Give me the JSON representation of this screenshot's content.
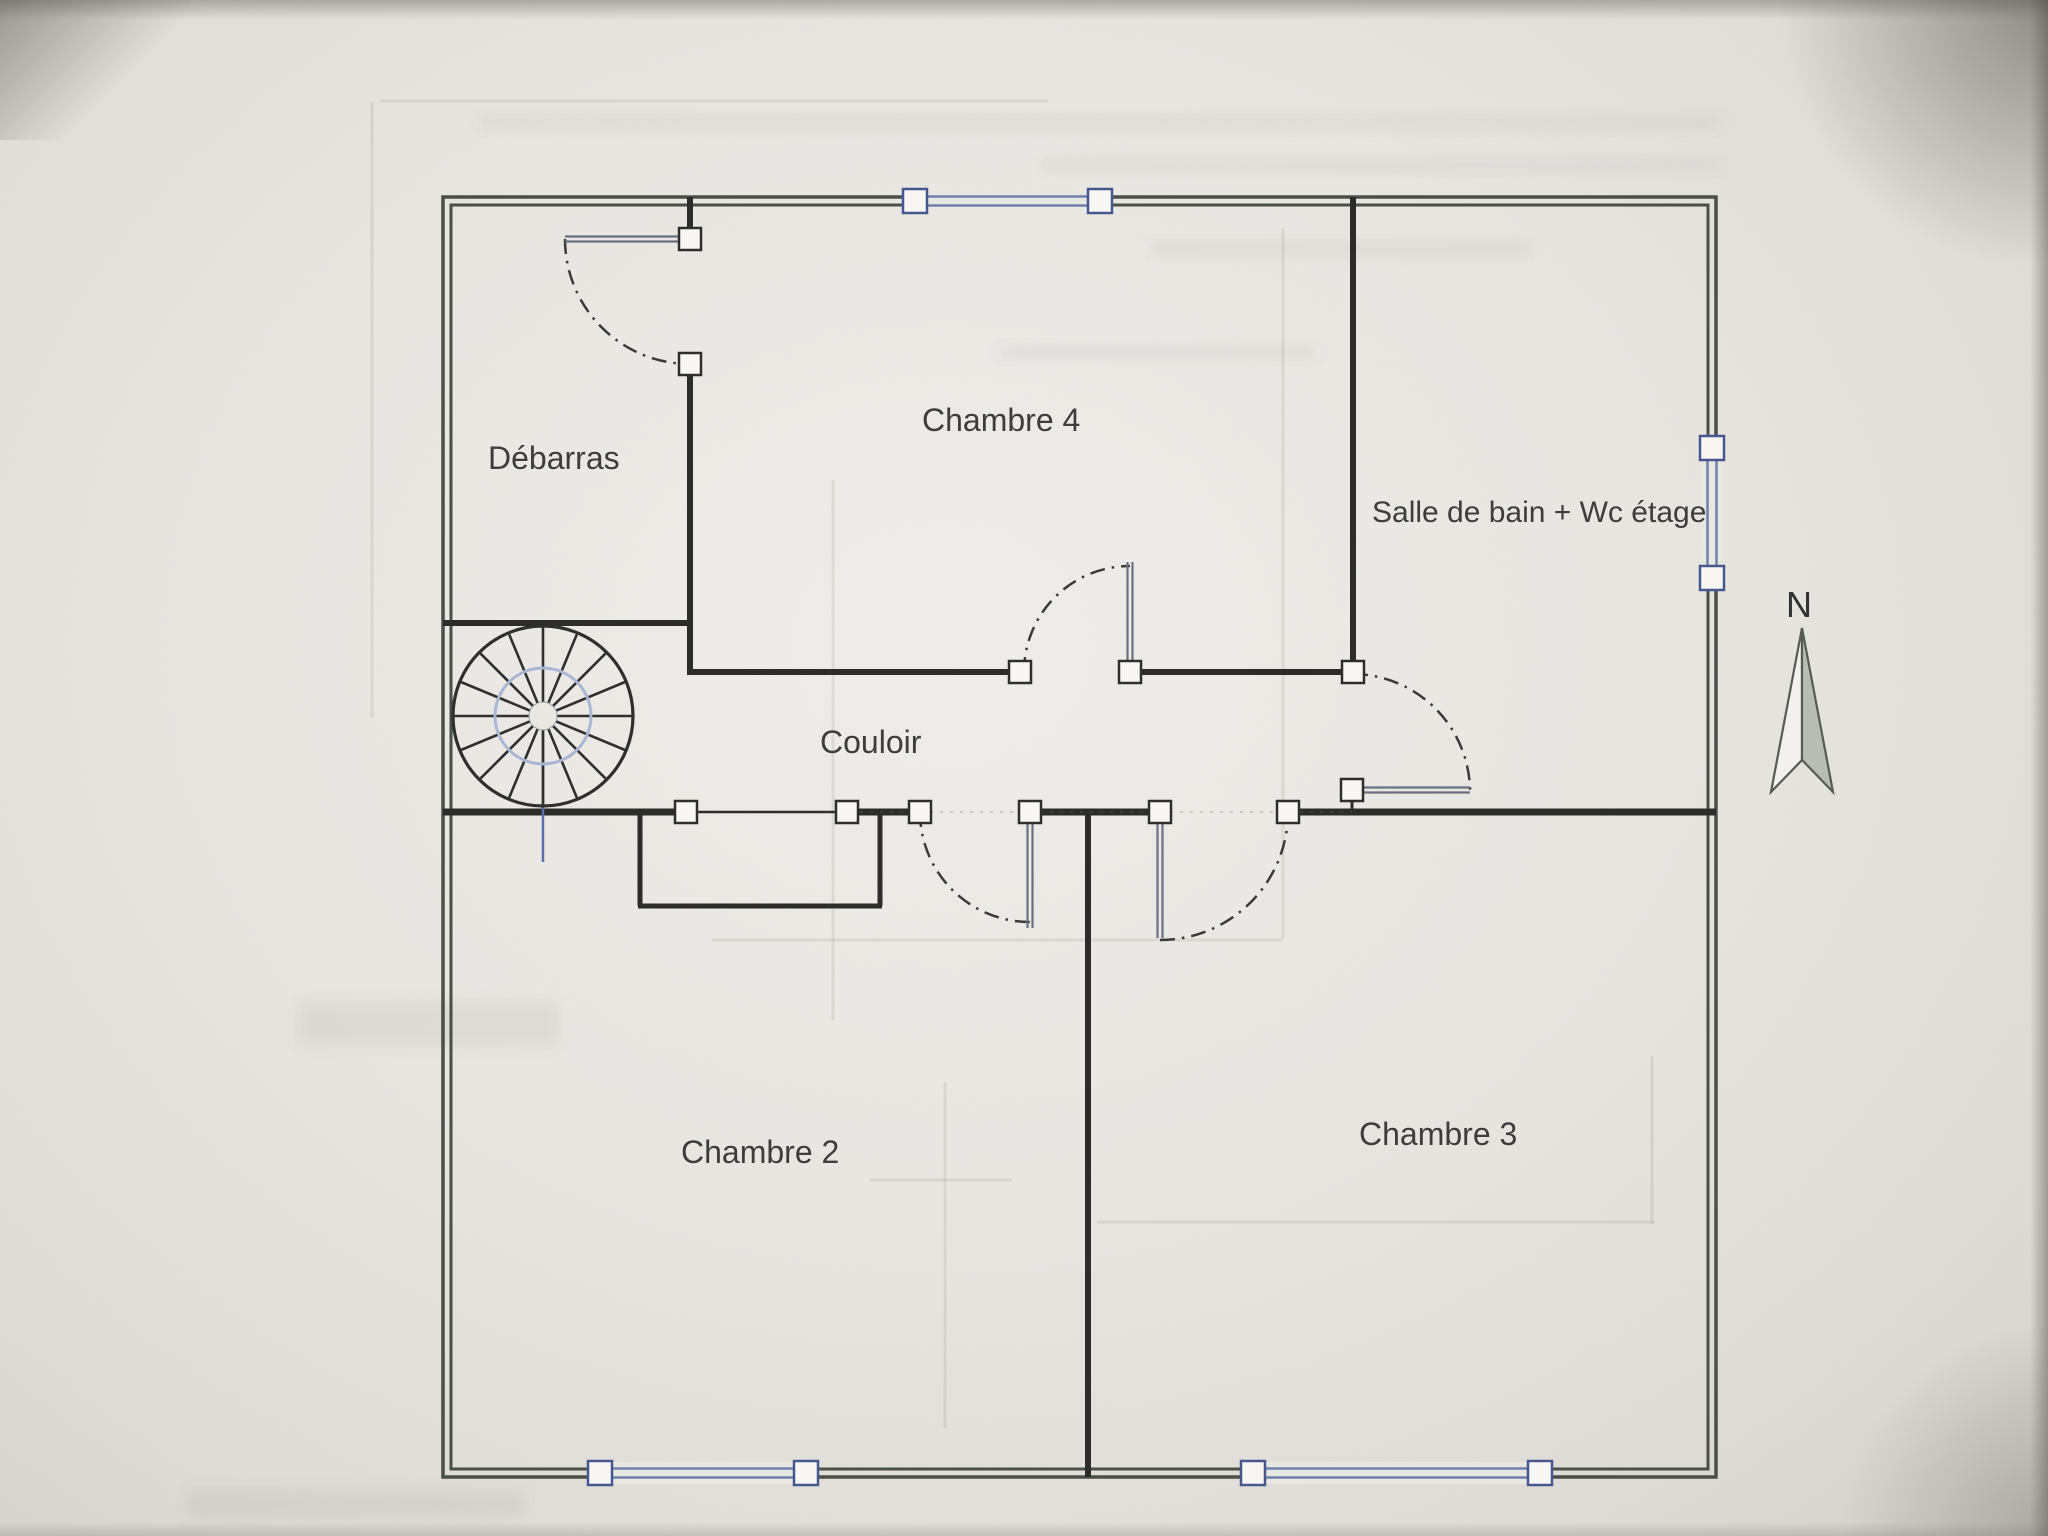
{
  "document": {
    "kind": "Scanned photo of an architectural floor plan (upper storey)",
    "language": "fr"
  },
  "colors": {
    "paper": "#e9e7e2",
    "exterior_wall": "#4a4f48",
    "interior_wall": "#2c2c2a",
    "window_blue": "#6f7fae",
    "window_square_border": "#47578f",
    "door_leaf": "#6a7080",
    "door_arc": "#3a3a38",
    "stair_line": "#2f2f2d",
    "stair_inner_circle": "#a9b7d4",
    "stair_axis_blue": "#5b6fa8",
    "label_text": "#3d3d3b",
    "north_arrow_fill": "#b7bcb4",
    "ghost": "#6e6960"
  },
  "floorplan": {
    "rooms": [
      {
        "id": "debarras",
        "label": "Débarras"
      },
      {
        "id": "chambre-4",
        "label": "Chambre 4"
      },
      {
        "id": "salle-de-bain-wc-etage",
        "label": "Salle de bain + Wc étage"
      },
      {
        "id": "couloir",
        "label": "Couloir"
      },
      {
        "id": "chambre-2",
        "label": "Chambre 2"
      },
      {
        "id": "chambre-3",
        "label": "Chambre 3"
      }
    ],
    "compass": {
      "label": "N"
    },
    "exterior": {
      "x": 443,
      "y": 197,
      "w": 1273,
      "h": 1280,
      "gap": 8
    },
    "interior_walls": [
      [
        690,
        197,
        690,
        245,
        6
      ],
      [
        690,
        364,
        690,
        675,
        6
      ],
      [
        443,
        623,
        690,
        623,
        6
      ],
      [
        687,
        672,
        1020,
        672,
        6
      ],
      [
        1130,
        672,
        1356,
        672,
        6
      ],
      [
        1353,
        197,
        1353,
        675,
        6
      ],
      [
        443,
        812,
        675,
        812,
        7
      ],
      [
        858,
        812,
        920,
        812,
        7
      ],
      [
        1041,
        812,
        1149,
        812,
        7
      ],
      [
        1299,
        812,
        1716,
        812,
        7
      ],
      [
        1088,
        812,
        1088,
        1477,
        6
      ],
      [
        640,
        815,
        640,
        906,
        5
      ],
      [
        638,
        906,
        882,
        906,
        5
      ],
      [
        880,
        815,
        880,
        906,
        5
      ],
      [
        1352,
        797,
        1352,
        812,
        3
      ]
    ],
    "opening_guides": [
      [
        860,
        812,
        1352,
        812
      ]
    ],
    "windows": [
      {
        "name": "window-north",
        "x1": 915,
        "y1": 201,
        "x2": 1100,
        "y2": 201
      },
      {
        "name": "window-east",
        "x1": 1712,
        "y1": 448,
        "x2": 1712,
        "y2": 578
      },
      {
        "name": "window-south-left",
        "x1": 600,
        "y1": 1473,
        "x2": 806,
        "y2": 1473
      },
      {
        "name": "window-south-right",
        "x1": 1253,
        "y1": 1473,
        "x2": 1540,
        "y2": 1473
      }
    ],
    "doors": [
      {
        "name": "door-debarras",
        "leaf": [
          684,
          239,
          565,
          239
        ],
        "arc": "M565,239 A125,125 0 0 0 690,364",
        "squares": [
          [
            690,
            239
          ],
          [
            690,
            364
          ]
        ]
      },
      {
        "name": "door-chambre-4",
        "leaf": [
          1130,
          666,
          1130,
          562
        ],
        "arc": "M1024,672 A106,106 0 0 1 1130,566",
        "squares": [
          [
            1020,
            672
          ],
          [
            1130,
            672
          ]
        ]
      },
      {
        "name": "door-chambre-2",
        "leaf": [
          1030,
          818,
          1030,
          928
        ],
        "arc": "M920,812 A110,110 0 0 0 1030,922",
        "squares": [
          [
            920,
            812
          ],
          [
            1030,
            812
          ]
        ]
      },
      {
        "name": "door-chambre-3",
        "leaf": [
          1160,
          818,
          1160,
          938
        ],
        "arc": "M1160,940 A128,128 0 0 0 1288,812",
        "squares": [
          [
            1160,
            812
          ],
          [
            1288,
            812
          ]
        ]
      },
      {
        "name": "door-salle-de-bain",
        "leaf": [
          1358,
          790,
          1470,
          790
        ],
        "arc": "M1353,674 A118,118 0 0 1 1470,790",
        "squares": [
          [
            1353,
            672
          ],
          [
            1352,
            790
          ]
        ]
      }
    ],
    "closet_opening": {
      "thin_line": [
        697,
        812,
        836,
        812
      ],
      "squares": [
        [
          686,
          812
        ],
        [
          847,
          812
        ]
      ]
    },
    "stair": {
      "cx": 543,
      "cy": 716,
      "r": 90,
      "inner_r": 48,
      "hub_r": 14,
      "spokes": 16,
      "axis_line": [
        543,
        716,
        543,
        862
      ]
    },
    "north_arrow": {
      "apex": [
        1802,
        628
      ],
      "left": [
        1771,
        792
      ],
      "notch": [
        1802,
        760
      ],
      "right": [
        1833,
        792
      ]
    },
    "ghost_lines": [
      [
        833,
        480,
        833,
        1020
      ],
      [
        1283,
        228,
        1283,
        938
      ],
      [
        712,
        940,
        1283,
        940
      ],
      [
        945,
        1082,
        945,
        1428
      ],
      [
        870,
        1180,
        1012,
        1180
      ],
      [
        1652,
        1056,
        1652,
        1224
      ],
      [
        1097,
        1222,
        1655,
        1222
      ],
      [
        372,
        102,
        372,
        718
      ],
      [
        380,
        101,
        1048,
        101
      ]
    ],
    "ghost_bands": [
      [
        480,
        116,
        1240,
        13
      ],
      [
        1040,
        159,
        680,
        12
      ],
      [
        1150,
        242,
        380,
        14
      ],
      [
        1000,
        346,
        315,
        13
      ],
      [
        298,
        1002,
        262,
        44
      ],
      [
        186,
        1490,
        338,
        28
      ]
    ]
  }
}
